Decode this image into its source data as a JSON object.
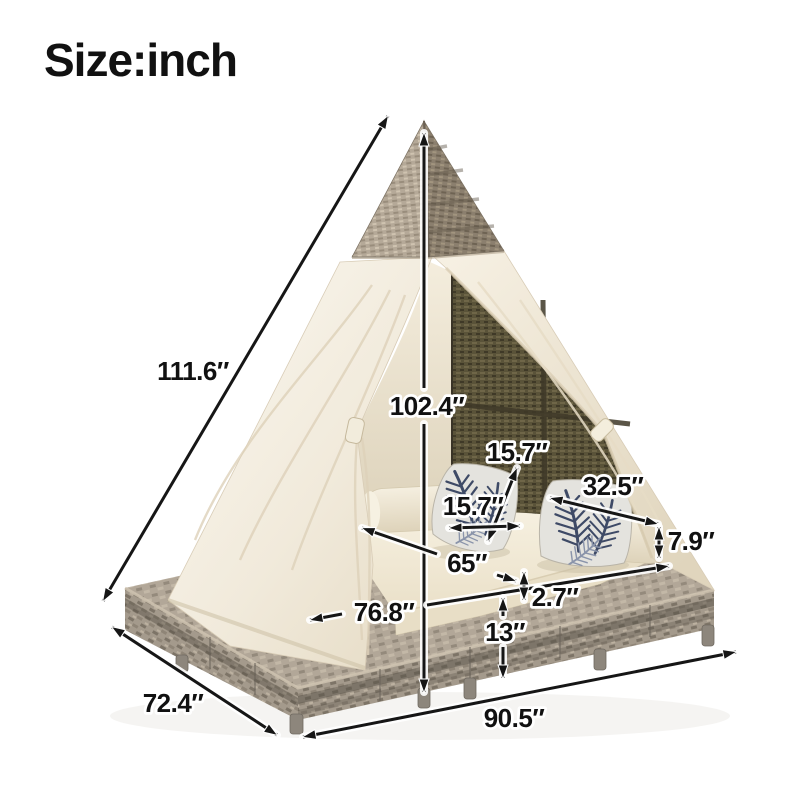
{
  "title": "Size:inch",
  "dimensions": {
    "side_slant_height": "111.6″",
    "tent_height": "102.4″",
    "pillow_side": "15.7″",
    "pillow_width": "15.7″",
    "backrest_depth": "32.5″",
    "cushion_thickness": "7.9″",
    "bed_length": "65″",
    "inner_width": "76.8″",
    "deck_lip": "2.7″",
    "base_height": "13″",
    "side_depth": "72.4″",
    "overall_width": "90.5″"
  },
  "colors": {
    "arrow": "#161616",
    "canvas": "#f1eadb",
    "wicker_top": "#a2957f",
    "mesh": "#5a5339",
    "base_wicker": "#a49a8c",
    "pillow_accent": "#3e4a66",
    "cushion": "#f6f0e0"
  }
}
